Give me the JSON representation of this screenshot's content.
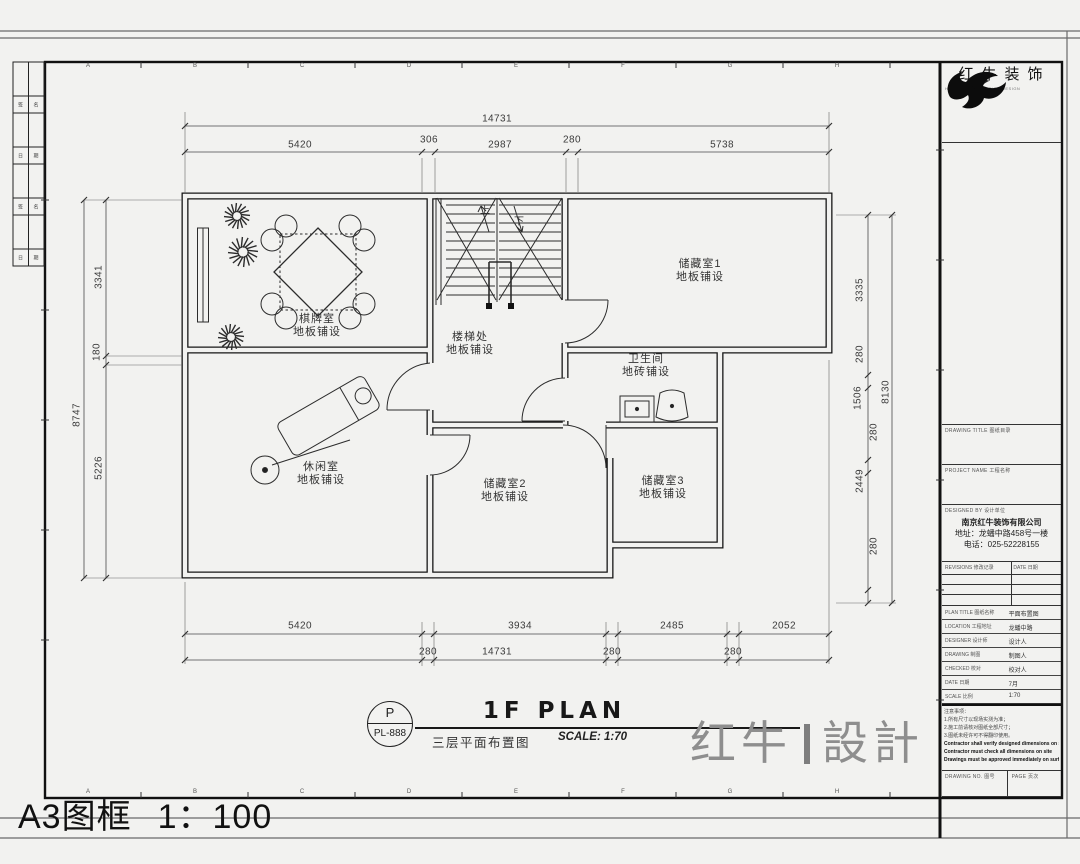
{
  "frame": {
    "label": "A3图框",
    "scale": "1：100"
  },
  "grid": {
    "letters": [
      "A",
      "B",
      "C",
      "D",
      "E",
      "F",
      "G",
      "H"
    ]
  },
  "left_strip": {
    "cells": [
      [
        "签",
        "名"
      ],
      [
        "日",
        "期"
      ],
      [
        "签",
        "名"
      ],
      [
        "日",
        "期"
      ]
    ]
  },
  "brand": {
    "name": "红牛装饰",
    "subtext": "HONGNIU DECORATION DESIGN",
    "watermark_left": "红牛",
    "watermark_right": "設計"
  },
  "title_block": {
    "field1_label": "DRAWING TITLE 图纸目录",
    "field2_label": "PROJECT NAME 工程名称",
    "company_label": "DESIGNED BY 设计单位",
    "company_name": "南京红牛装饰有限公司",
    "company_address": "地址：龙蟠中路458号一楼",
    "company_phone": "电话：025-52228155",
    "rev_label": "REVISIONS 修改记录",
    "rev_date": "DATE 日期",
    "rows": [
      {
        "label": "PLAN TITLE 图纸名称",
        "value": "平面布置图"
      },
      {
        "label": "LOCATION 工程地址",
        "value": "龙蟠中路"
      },
      {
        "label": "DESIGNER 设计师",
        "value": "设计人"
      },
      {
        "label": "DRAWING 制图",
        "value": "制图人"
      },
      {
        "label": "CHECKED 校对",
        "value": "校对人"
      },
      {
        "label": "DATE 日期",
        "value": "7月"
      },
      {
        "label": "SCALE 比例",
        "value": "1:70"
      }
    ],
    "notes": [
      {
        "text": "注意事项：",
        "bold": false
      },
      {
        "text": "1.所有尺寸以现场实测为准；",
        "bold": false
      },
      {
        "text": "2.施工前请核对图纸全部尺寸；",
        "bold": false
      },
      {
        "text": "3.图纸未经许可不得翻印使用。",
        "bold": false
      },
      {
        "text": "Contractor shall verify designed dimensions on site",
        "bold": true
      },
      {
        "text": "Contractor must check all dimensions on site",
        "bold": true
      },
      {
        "text": "Drawings must be approved immediately on surfaces",
        "bold": true
      }
    ],
    "bottom_left_label": "DRAWING NO. 图号",
    "bottom_right_label": "PAGE 页次"
  },
  "plan": {
    "title": "1F PLAN",
    "scale_note": "SCALE: 1:70",
    "tag_letter": "P",
    "tag_code": "PL-888",
    "subtitle": "三层平面布置图",
    "stair_up": "上",
    "stair_down": "下",
    "rooms": [
      {
        "name": "棋牌室",
        "finish": "地板铺设",
        "x": 317,
        "y": 313
      },
      {
        "name": "楼梯处",
        "finish": "地板铺设",
        "x": 470,
        "y": 331
      },
      {
        "name": "储藏室1",
        "finish": "地板铺设",
        "x": 700,
        "y": 258
      },
      {
        "name": "卫生间",
        "finish": "地砖铺设",
        "x": 646,
        "y": 353
      },
      {
        "name": "休闲室",
        "finish": "地板铺设",
        "x": 321,
        "y": 461
      },
      {
        "name": "储藏室2",
        "finish": "地板铺设",
        "x": 505,
        "y": 478
      },
      {
        "name": "储藏室3",
        "finish": "地板铺设",
        "x": 663,
        "y": 475
      }
    ],
    "dimensions": [
      {
        "t": "14731",
        "x": 497,
        "y": 119
      },
      {
        "t": "5420",
        "x": 300,
        "y": 145
      },
      {
        "t": "306",
        "x": 429,
        "y": 140
      },
      {
        "t": "2987",
        "x": 500,
        "y": 145
      },
      {
        "t": "280",
        "x": 572,
        "y": 140
      },
      {
        "t": "5738",
        "x": 722,
        "y": 145
      },
      {
        "t": "8747",
        "x": 77,
        "y": 415,
        "r": 1
      },
      {
        "t": "3341",
        "x": 99,
        "y": 277,
        "r": 1
      },
      {
        "t": "180",
        "x": 97,
        "y": 352,
        "r": 1
      },
      {
        "t": "5226",
        "x": 99,
        "y": 468,
        "r": 1
      },
      {
        "t": "3335",
        "x": 860,
        "y": 290,
        "r": 1
      },
      {
        "t": "280",
        "x": 860,
        "y": 354,
        "r": 1
      },
      {
        "t": "1506",
        "x": 858,
        "y": 398,
        "r": 1
      },
      {
        "t": "8130",
        "x": 886,
        "y": 392,
        "r": 1
      },
      {
        "t": "280",
        "x": 874,
        "y": 432,
        "r": 1
      },
      {
        "t": "2449",
        "x": 860,
        "y": 481,
        "r": 1
      },
      {
        "t": "280",
        "x": 874,
        "y": 546,
        "r": 1
      },
      {
        "t": "5420",
        "x": 300,
        "y": 626
      },
      {
        "t": "3934",
        "x": 520,
        "y": 626
      },
      {
        "t": "2485",
        "x": 672,
        "y": 626
      },
      {
        "t": "2052",
        "x": 784,
        "y": 626
      },
      {
        "t": "280",
        "x": 428,
        "y": 652
      },
      {
        "t": "14731",
        "x": 497,
        "y": 652
      },
      {
        "t": "280",
        "x": 612,
        "y": 652
      },
      {
        "t": "280",
        "x": 733,
        "y": 652
      }
    ]
  }
}
